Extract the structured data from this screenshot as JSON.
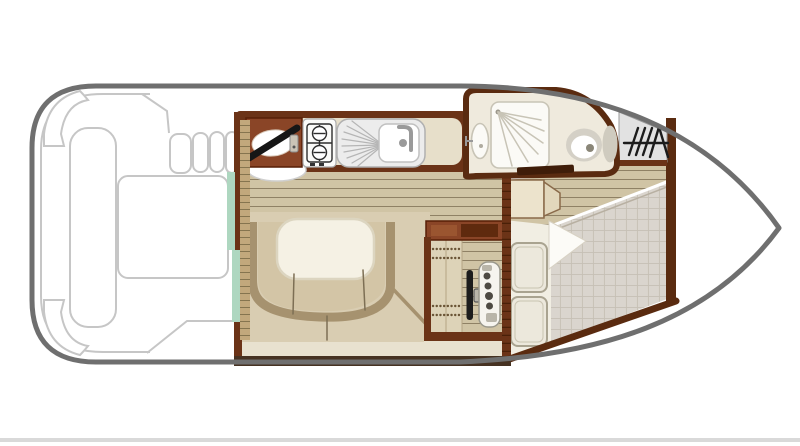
{
  "meta": {
    "title": "Canal boat cabin floor plan (top view)",
    "kind": "boat-floorplan-diagram",
    "text_visible": false
  },
  "palette": {
    "hull_outline": "#6f6f6f",
    "hull_fill": "#ffffff",
    "deck_line": "#c6c6c6",
    "wall_dark": "#5a2b10",
    "wall_mid": "#6b3317",
    "wall_bottom": "#463222",
    "cabinet_sienna": "#8a4527",
    "cabinet_panel": "#9a5530",
    "cabinet_dark": "#5f2a0e",
    "counter": "#e7dfca",
    "plank": "#d0c4a5",
    "plank_line": "#8f8165",
    "floor_dinette": "#d9cdb2",
    "apron": "#e8e1cf",
    "bench_back": "#a6926f",
    "bench_seat": "#d3c5a6",
    "table": "#f5f1e4",
    "table_edge": "#dcd5c0",
    "mint": "#aed7c0",
    "rung_wood": "#c2a87c",
    "rung_line": "#85744f",
    "bath_floor": "#efeadd",
    "fixture_white": "#fbfaf6",
    "fixture_line": "#c8c4b6",
    "gray_fix": "#b9b5a9",
    "steel": "#9a9a9a",
    "locker_gray": "#e2e2e2",
    "glyph_black": "#1c1c1c",
    "quilt": "#dad5ce",
    "quilt_line": "#c6c0b5",
    "sheet": "#f1eee3",
    "pillow": "#ece8dc",
    "pillow_edge": "#a9a390",
    "wardrobe": "#ece3cc",
    "wardrobe2": "#e2d7bc",
    "wardrobe_edge": "#8a6a4a",
    "helm_cabinet": "#ddd3b8",
    "door_dark": "#3f1d09",
    "artifact_band": "#d9d9d9"
  },
  "areas": [
    {
      "id": "aft-deck",
      "features": [
        "corner-locker",
        "stern-bench",
        "engine-hatch",
        "boarding-steps"
      ]
    },
    {
      "id": "galley",
      "features": [
        "round-sink",
        "faucet-bar",
        "two-burner-hob",
        "sink-with-drainer",
        "counter"
      ]
    },
    {
      "id": "bathroom",
      "features": [
        "shower",
        "washbasin",
        "toilet",
        "cistern",
        "door"
      ]
    },
    {
      "id": "anchor-locker",
      "features": [
        "anchor-symbol",
        "hatch-marks"
      ]
    },
    {
      "id": "dinette",
      "features": [
        "u-shaped-bench",
        "table"
      ]
    },
    {
      "id": "helm",
      "features": [
        "storage-cabinet",
        "steering-wheel",
        "wheel-hub",
        "instrument-console"
      ]
    },
    {
      "id": "bow-cabin",
      "features": [
        "wardrobe",
        "double-bed",
        "pillows",
        "duvet",
        "folded-sheet"
      ]
    }
  ]
}
